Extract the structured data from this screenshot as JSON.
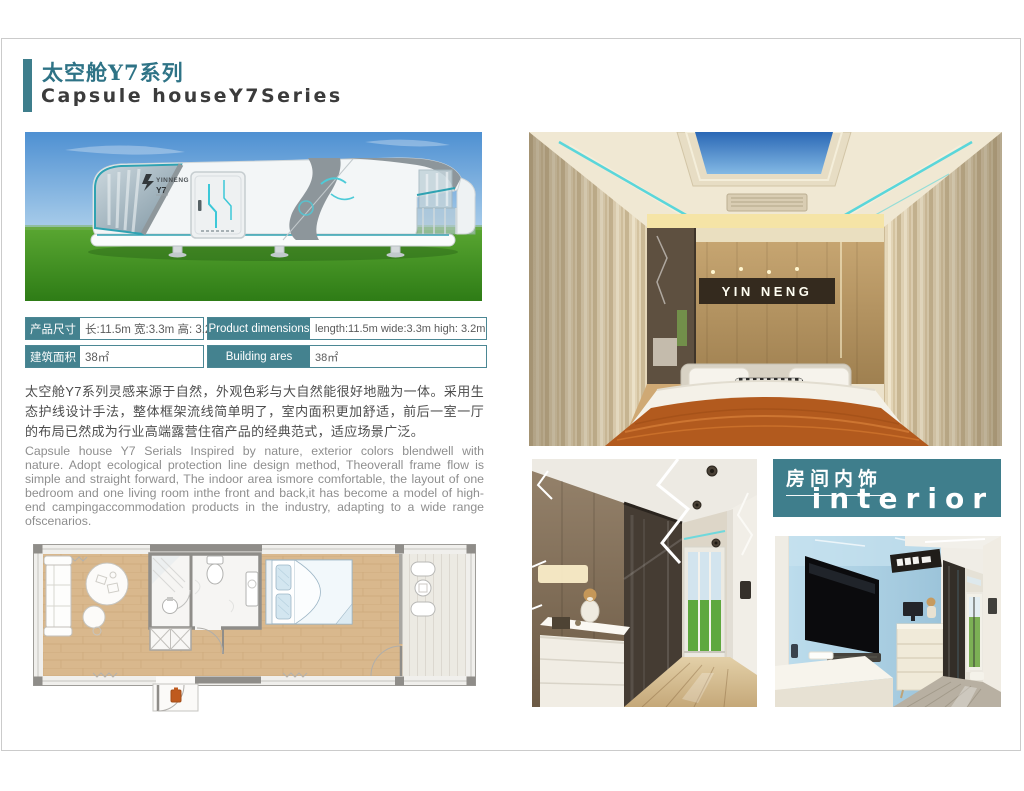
{
  "header": {
    "title_zh": "太空舱Y7系列",
    "title_en": "Capsule houseY7Series"
  },
  "spec_table": {
    "left": [
      {
        "label": "产品尺寸",
        "value": "长:11.5m 宽:3.3m 高: 3.2m"
      },
      {
        "label": "建筑面积",
        "value": "38㎡"
      }
    ],
    "right": [
      {
        "label": "Product dimensions",
        "value": "length:11.5m wide:3.3m high: 3.2m"
      },
      {
        "label": "Building ares",
        "value": "38㎡"
      }
    ]
  },
  "description": {
    "zh": "太空舱Y7系列灵感来源于自然，外观色彩与大自然能很好地融为一体。采用生态护线设计手法，整体框架流线简单明了，室内面积更加舒适，前后一室一厅的布局已然成为行业高端露营住宿产品的经典范式，适应场景广泛。",
    "en": "Capsule house Y7 Serials Inspired by nature, exterior colors blendwell with nature. Adopt ecological protection line design method, Theoverall frame flow is simple and straight forward, The indoor area ismore comfortable, the layout of one bedroom and one living room inthe front and back,it has become a model of high-end campingaccommodation products in the industry, adapting to a wide range ofscenarios."
  },
  "interior_badge": {
    "zh": "房间内饰",
    "en": "interior"
  },
  "photos": {
    "exterior": {
      "brand": "YINNENG",
      "model": "Y7"
    },
    "bedroom": {
      "sign": "YIN NENG"
    }
  },
  "colors": {
    "teal": "#3E7E8C",
    "accent_cyan": "#5AD6DA",
    "title_teal": "#2E7386",
    "frame_border": "#CBCBCB"
  }
}
